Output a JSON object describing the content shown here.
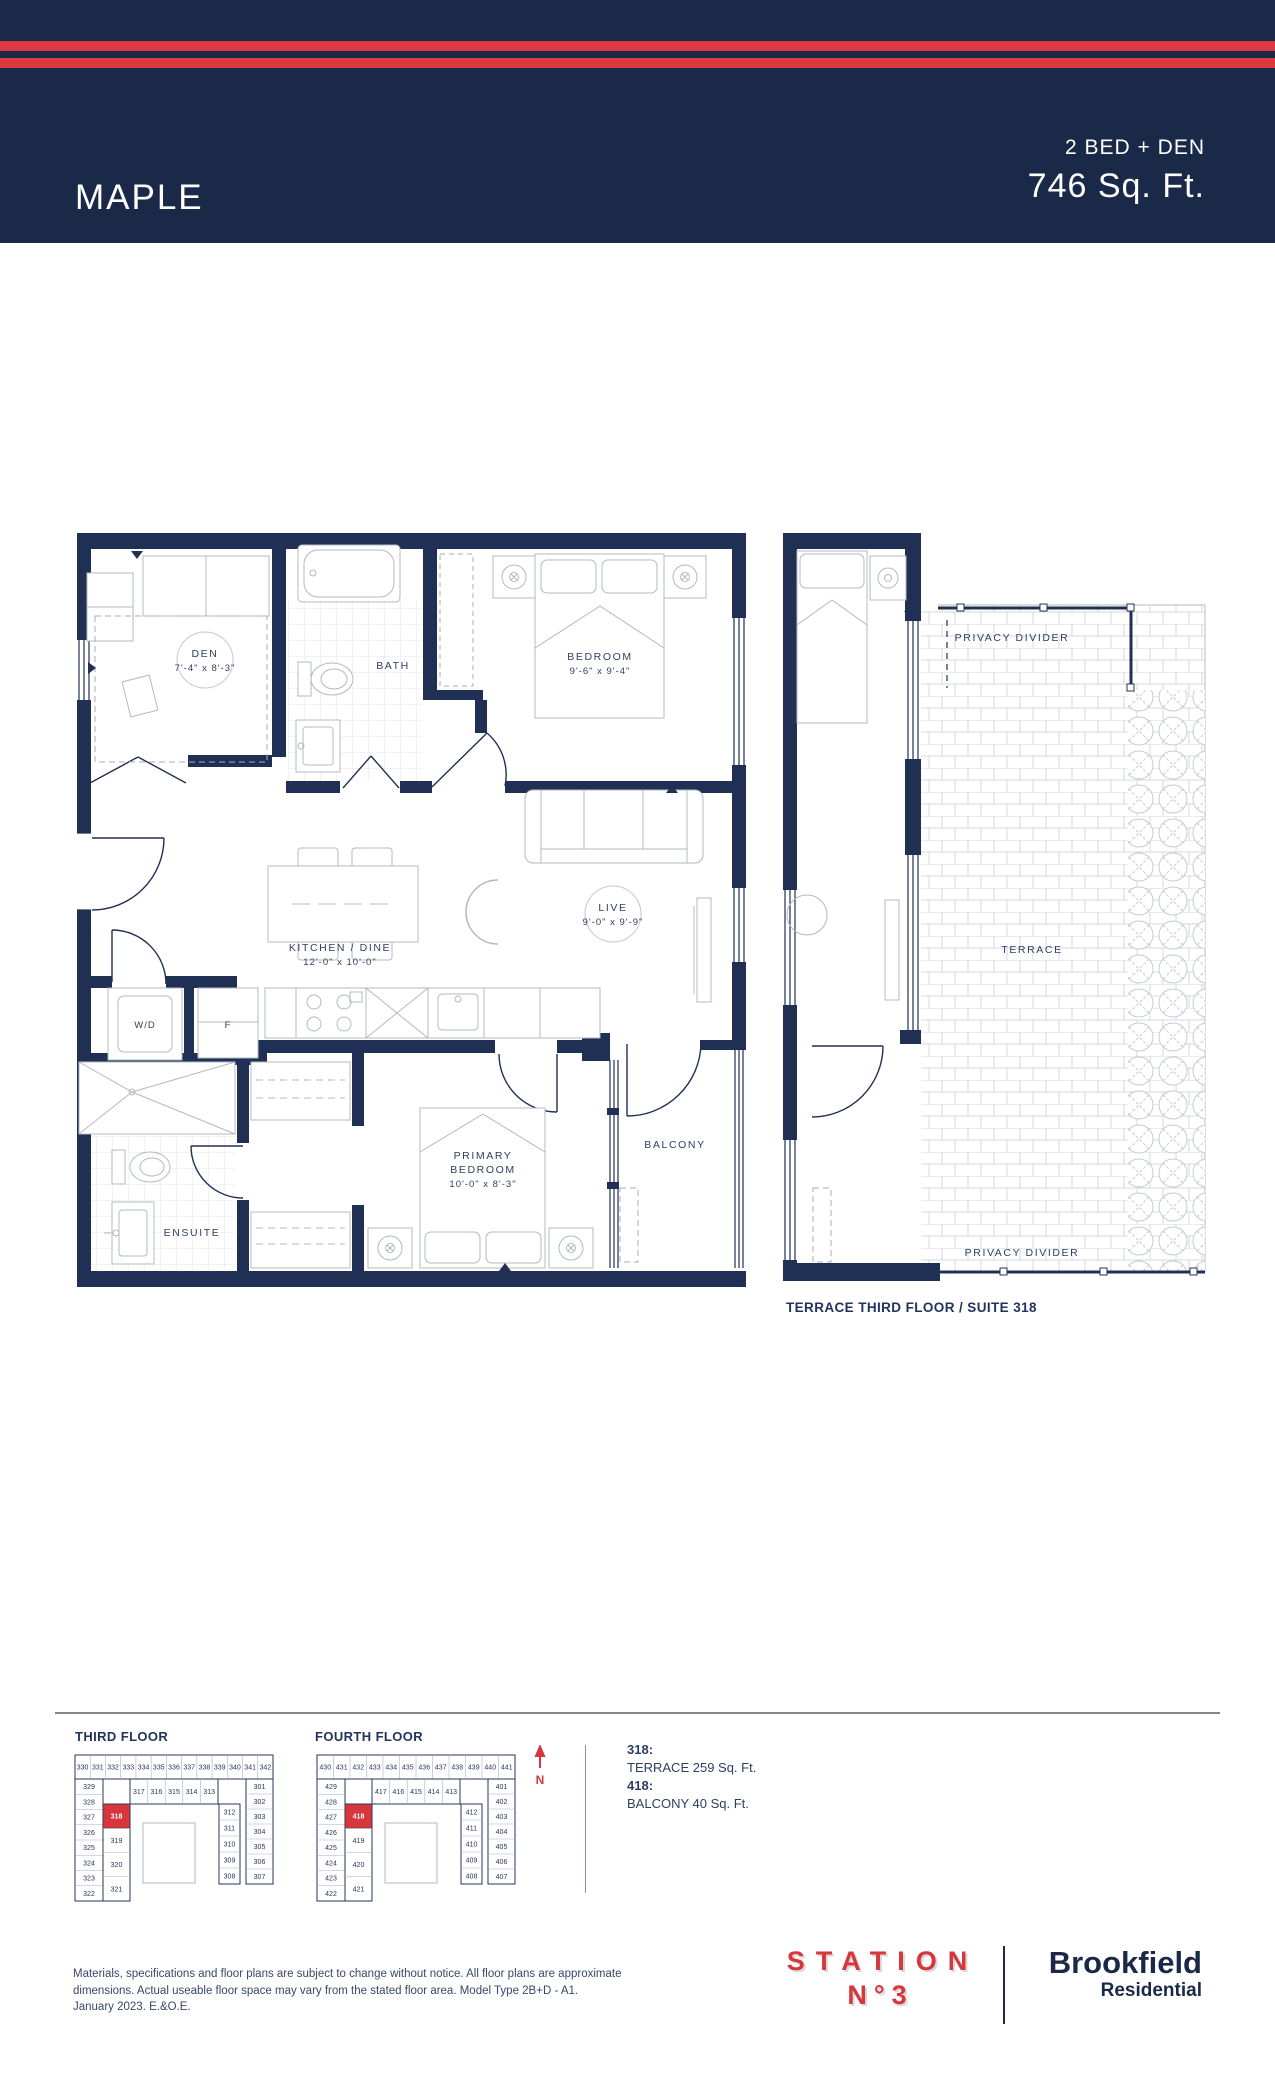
{
  "header": {
    "title": "MAPLE",
    "plan_type": "2 BED + DEN",
    "area": "746 Sq. Ft."
  },
  "colors": {
    "navy": "#1b2949",
    "red": "#da3a40",
    "wall": "#203055",
    "highlight": "#d7363d"
  },
  "floorplan": {
    "den_name": "DEN",
    "den_dims": "7'-4\" x 8'-3\"",
    "bath_name": "BATH",
    "bedroom_name": "BEDROOM",
    "bedroom_dims": "9'-6\" x 9'-4\"",
    "kitchen_name": "KITCHEN / DINE",
    "kitchen_dims": "12'-0\" x 10'-0\"",
    "live_name": "LIVE",
    "live_dims": "9'-0\" x 9'-9\"",
    "wd_name": "W/D",
    "fridge_name": "F",
    "primary_name_line1": "PRIMARY",
    "primary_name_line2": "BEDROOM",
    "primary_dims": "10'-0\" x 8'-3\"",
    "ensuite_name": "ENSUITE",
    "balcony_name": "BALCONY"
  },
  "terrace_plan": {
    "privacy_divider_top": "PRIVACY DIVIDER",
    "terrace_label": "TERRACE",
    "privacy_divider_bottom": "PRIVACY DIVIDER",
    "caption": "TERRACE THIRD FLOOR / SUITE 318"
  },
  "keyplans": {
    "third": {
      "title": "THIRD FLOOR",
      "highlight": "318",
      "units": {
        "top": [
          "330",
          "331",
          "332",
          "333",
          "334",
          "335",
          "336",
          "337",
          "338",
          "339",
          "340",
          "341",
          "342"
        ],
        "left": [
          "329",
          "328",
          "327",
          "326",
          "325",
          "324",
          "323",
          "322"
        ],
        "inner_left": [
          "318",
          "319",
          "320",
          "321"
        ],
        "inner_top": [
          "317",
          "316",
          "315",
          "314",
          "313"
        ],
        "right_inner": [
          "312",
          "311",
          "310",
          "309",
          "308"
        ],
        "right_outer": [
          "301",
          "302",
          "303",
          "304",
          "305",
          "306",
          "307"
        ]
      }
    },
    "fourth": {
      "title": "FOURTH FLOOR",
      "highlight": "418",
      "units": {
        "top": [
          "430",
          "431",
          "432",
          "433",
          "434",
          "435",
          "436",
          "437",
          "438",
          "439",
          "440",
          "441"
        ],
        "left": [
          "429",
          "428",
          "427",
          "426",
          "425",
          "424",
          "423",
          "422"
        ],
        "inner_left": [
          "418",
          "419",
          "420",
          "421"
        ],
        "inner_top": [
          "417",
          "416",
          "415",
          "414",
          "413"
        ],
        "right_inner": [
          "412",
          "411",
          "410",
          "409",
          "408"
        ],
        "right_outer": [
          "401",
          "402",
          "403",
          "404",
          "405",
          "406",
          "407"
        ]
      }
    }
  },
  "legend": {
    "north_label": "N",
    "items": [
      {
        "label": "318:",
        "value": "TERRACE 259 Sq. Ft."
      },
      {
        "label": "418:",
        "value": "BALCONY 40 Sq. Ft."
      }
    ]
  },
  "footer": {
    "disclaimer_line1": "Materials, specifications and floor plans are subject to change without notice. All floor plans are approximate",
    "disclaimer_line2": "dimensions. Actual useable floor space may vary from the stated floor area. Model Type 2B+D - A1.",
    "disclaimer_line3": "January 2023. E.&O.E.",
    "station_logo_line1": "STATION",
    "station_logo_line2": "N°3",
    "brookfield_line1": "Brookfield",
    "brookfield_line2": "Residential"
  }
}
